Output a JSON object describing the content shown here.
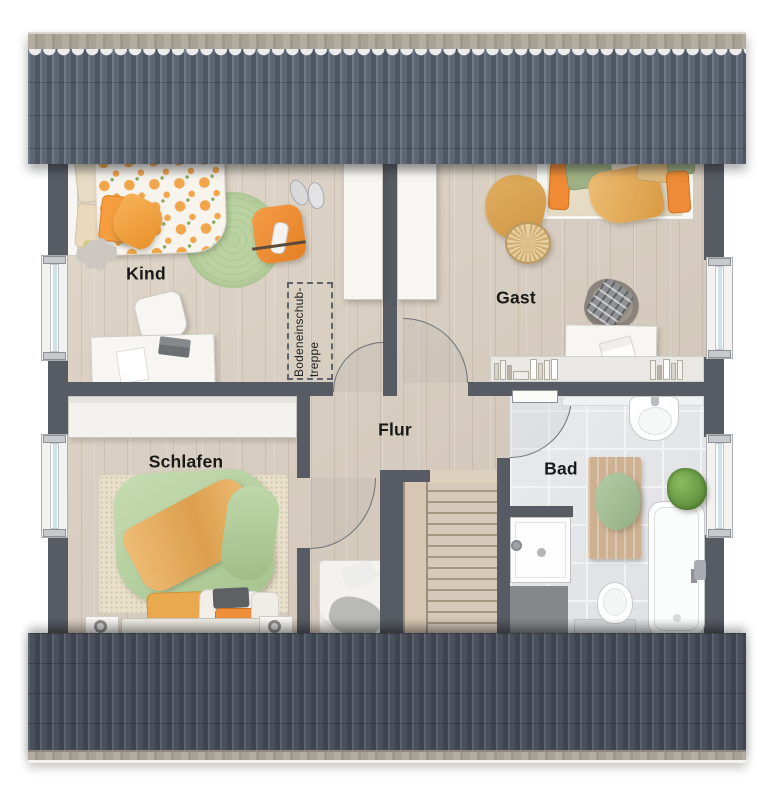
{
  "rooms": {
    "kind": "Kind",
    "gast": "Gast",
    "schlafen": "Schlafen",
    "flur": "Flur",
    "bad": "Bad"
  },
  "attic_ladder": {
    "line1": "Bodeneinschub-",
    "line2": "treppe"
  },
  "palette": {
    "wall": "#575b63",
    "roof_top_tiles": "#5d6672",
    "roof_bottom_tiles": "#49505b",
    "roof_ridge": "#a8a295",
    "floor_wood": "#d9cfc2",
    "floor_tile": "#e4e5e7",
    "accent_orange": "#ef8f3a",
    "accent_green": "#aecb94",
    "duvet_green": "#b7d2a2",
    "blanket_orange": "#e9b169",
    "window_glass": "#cfe2ea"
  }
}
